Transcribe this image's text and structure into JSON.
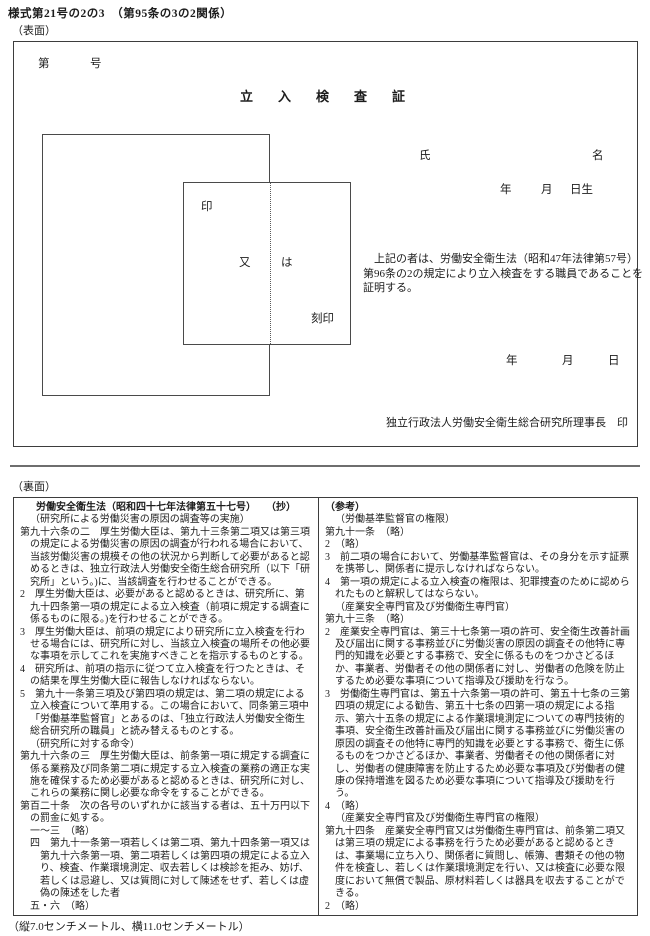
{
  "page": {
    "form_number": "様式第21号の2の3　（第95条の3の2関係）",
    "front_label": "（表面）",
    "back_label": "（裏面）",
    "size_note": "（縦7.0センチメートル、横11.0センチメートル）"
  },
  "front": {
    "doc_number_prefix": "第",
    "doc_number_suffix": "号",
    "title": "立　入　検　査　証",
    "seal": {
      "in": "印",
      "mata": "又",
      "ha": "は",
      "kokuin": "刻印"
    },
    "name_label_sei": "氏",
    "name_label_mei": "名",
    "birth_year": "年",
    "birth_month": "月",
    "birth_day": "日生",
    "certification_text": "上記の者は、労働安全衛生法（昭和47年法律第57号）第96条の2の規定により立入検査をする職員であることを証明する。",
    "date_year": "年",
    "date_month": "月",
    "date_day": "日",
    "issuer": "独立行政法人労働安全衛生総合研究所理事長　印"
  },
  "back": {
    "left": {
      "title": "労働安全衛生法（昭和四十七年法律第五十七号）　　（抄）",
      "paragraphs": [
        {
          "cls": "ind1",
          "t": "（研究所による労働災害の原因の調査等の実施）"
        },
        {
          "cls": "hang1",
          "t": "第九十六条の二　厚生労働大臣は、第九十三条第二項又は第三項の規定による労働災害の原因の調査が行われる場合において、当該労働災害の規模その他の状況から判断して必要があると認めるときは、独立行政法人労働安全衛生総合研究所（以下「研究所」という。)に、当該調査を行わせることができる。"
        },
        {
          "cls": "hang1",
          "t": "2　厚生労働大臣は、必要があると認めるときは、研究所に、第九十四条第一項の規定による立入検査（前項に規定する調査に係るものに限る。)を行わせることができる。"
        },
        {
          "cls": "hang1",
          "t": "3　厚生労働大臣は、前項の規定により研究所に立入検査を行わせる場合には、研究所に対し、当該立入検査の場所その他必要な事項を示してこれを実施すべきことを指示するものとする。"
        },
        {
          "cls": "hang1",
          "t": "4　研究所は、前項の指示に従つて立入検査を行つたときは、その結果を厚生労働大臣に報告しなければならない。"
        },
        {
          "cls": "hang1",
          "t": "5　第九十一条第三項及び第四項の規定は、第二項の規定による立入検査について準用する。この場合において、同条第三項中「労働基準監督官」とあるのは、「独立行政法人労働安全衛生総合研究所の職員」と読み替えるものとする。"
        },
        {
          "cls": "ind1",
          "t": "（研究所に対する命令）"
        },
        {
          "cls": "hang1",
          "t": "第九十六条の三　厚生労働大臣は、前条第一項に規定する調査に係る業務及び同条第二項に規定する立入検査の業務の適正な実施を確保するため必要があると認めるときは、研究所に対し、これらの業務に関し必要な命令をすることができる。"
        },
        {
          "cls": "hang1",
          "t": "第百二十条　次の各号のいずれかに該当する者は、五十万円以下の罰金に処する。"
        },
        {
          "cls": "ind1",
          "t": "一～三　（略）"
        },
        {
          "cls": "hang2",
          "t": "四　第九十一条第一項若しくは第二項、第九十四条第一項又は第九十六条第一項、第二項若しくは第四項の規定による立入り、検査、作業環境測定、収去若しくは検診を拒み、妨げ、若しくは忌避し、又は質問に対して陳述をせず、若しくは虚偽の陳述をした者"
        },
        {
          "cls": "ind1",
          "t": "五・六　（略）"
        }
      ]
    },
    "right": {
      "title": "（参考）",
      "paragraphs": [
        {
          "cls": "ind1",
          "t": "（労働基準監督官の権限）"
        },
        {
          "cls": "flush",
          "t": "第九十一条　（略）"
        },
        {
          "cls": "flush",
          "t": "2　（略）"
        },
        {
          "cls": "hang1",
          "t": "3　前二項の場合において、労働基準監督官は、その身分を示す証票を携帯し、関係者に提示しなければならない。"
        },
        {
          "cls": "hang1",
          "t": "4　第一項の規定による立入検査の権限は、犯罪捜査のために認められたものと解釈してはならない。"
        },
        {
          "cls": "ind1",
          "t": "（産業安全専門官及び労働衛生専門官）"
        },
        {
          "cls": "flush",
          "t": "第九十三条　（略）"
        },
        {
          "cls": "hang1",
          "t": "2　産業安全専門官は、第三十七条第一項の許可、安全衛生改善計画及び届出に関する事務並びに労働災害の原因の調査その他特に専門的知識を必要とする事務で、安全に係るものをつかさどるほか、事業者、労働者その他の関係者に対し、労働者の危険を防止するため必要な事項について指導及び援助を行なう。"
        },
        {
          "cls": "hang1",
          "t": "3　労働衛生専門官は、第五十六条第一項の許可、第五十七条の三第四項の規定による勧告、第五十七条の四第一項の規定による指示、第六十五条の規定による作業環境測定についての専門技術的事項、安全衛生改善計画及び届出に関する事務並びに労働災害の原因の調査その他特に専門的知識を必要とする事務で、衛生に係るものをつかさどるほか、事業者、労働者その他の関係者に対し、労働者の健康障害を防止するため必要な事項及び労働者の健康の保持増進を図るため必要な事項について指導及び援助を行う。"
        },
        {
          "cls": "flush",
          "t": "4　（略）"
        },
        {
          "cls": "ind1",
          "t": "（産業安全専門官及び労働衛生専門官の権限）"
        },
        {
          "cls": "hang1",
          "t": "第九十四条　産業安全専門官又は労働衛生専門官は、前条第二項又は第三項の規定による事務を行うため必要があると認めるときは、事業場に立ち入り、関係者に質問し、帳簿、書類その他の物件を検査し、若しくは作業環境測定を行い、又は検査に必要な限度において無償で製品、原材料若しくは器具を収去することができる。"
        },
        {
          "cls": "flush",
          "t": "2　（略）"
        }
      ]
    }
  }
}
